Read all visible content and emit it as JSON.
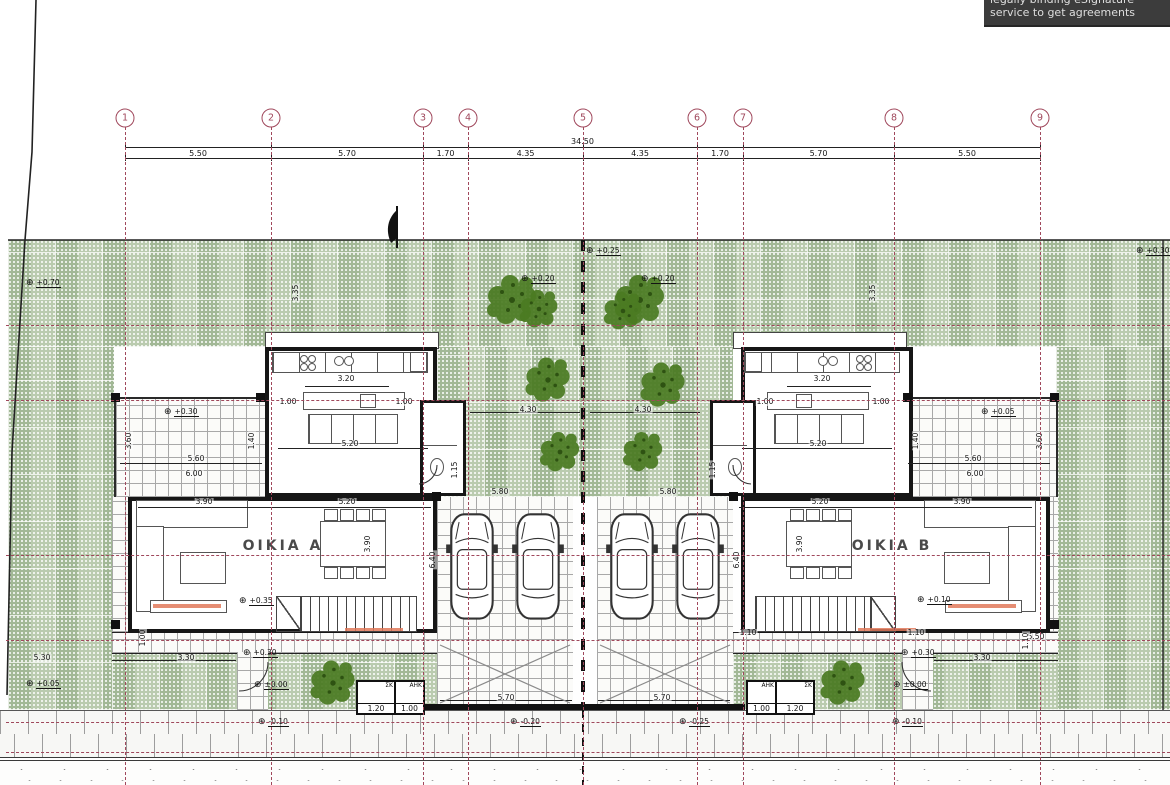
{
  "watermark": {
    "line1": "legally binding eSignature",
    "line2": "service to get agreements",
    "bg": "#3c3c3c",
    "fg": "#dedede"
  },
  "colors": {
    "axis_red": "#a0485c",
    "garden_green": "#b0c4a4",
    "tree_green": "#4b7b22",
    "wall_black": "#161616",
    "accent_orange": "#e0795a"
  },
  "grid": {
    "total_label": "34.50",
    "axes": [
      {
        "n": "1",
        "x": 125
      },
      {
        "n": "2",
        "x": 271
      },
      {
        "n": "3",
        "x": 423
      },
      {
        "n": "4",
        "x": 468
      },
      {
        "n": "5",
        "x": 583
      },
      {
        "n": "6",
        "x": 697
      },
      {
        "n": "7",
        "x": 743
      },
      {
        "n": "8",
        "x": 894
      },
      {
        "n": "9",
        "x": 1040
      }
    ],
    "segments": [
      "5.50",
      "5.70",
      "1.70",
      "4.35",
      "4.35",
      "1.70",
      "5.70",
      "5.50"
    ]
  },
  "houses": [
    {
      "name": "OIKIA A",
      "x": 283,
      "y": 546
    },
    {
      "name": "OIKIA B",
      "x": 892,
      "y": 546
    }
  ],
  "meter_boxes": [
    {
      "label": "ΣΚ",
      "value": "1.20",
      "x": 356,
      "y": 680,
      "w": 36,
      "h": 31
    },
    {
      "label": "ΑΗΚ",
      "value": "1.00",
      "x": 394,
      "y": 680,
      "w": 27,
      "h": 31
    },
    {
      "label": "ΑΗΚ",
      "value": "1.00",
      "x": 746,
      "y": 680,
      "w": 27,
      "h": 31
    },
    {
      "label": "ΣΚ",
      "value": "1.20",
      "x": 775,
      "y": 680,
      "w": 36,
      "h": 31
    }
  ],
  "levels": [
    {
      "label": "+0.70",
      "x": 30,
      "y": 283
    },
    {
      "label": "+0.25",
      "x": 590,
      "y": 251
    },
    {
      "label": "+0.20",
      "x": 525,
      "y": 279
    },
    {
      "label": "+0.20",
      "x": 645,
      "y": 279
    },
    {
      "label": "+0.30",
      "x": 1140,
      "y": 251
    },
    {
      "label": "+0.30",
      "x": 168,
      "y": 412
    },
    {
      "label": "+0.05",
      "x": 985,
      "y": 412
    },
    {
      "label": "+0.35",
      "x": 243,
      "y": 601
    },
    {
      "label": "+0.10",
      "x": 921,
      "y": 600
    },
    {
      "label": "+0.30",
      "x": 247,
      "y": 653
    },
    {
      "label": "±0.00",
      "x": 258,
      "y": 685
    },
    {
      "label": "-0.10",
      "x": 262,
      "y": 722
    },
    {
      "label": "-0.20",
      "x": 514,
      "y": 722
    },
    {
      "label": "-0.25",
      "x": 683,
      "y": 722
    },
    {
      "label": "+0.30",
      "x": 905,
      "y": 653
    },
    {
      "label": "±0.00",
      "x": 897,
      "y": 685
    },
    {
      "label": "-0.10",
      "x": 896,
      "y": 722
    },
    {
      "label": "+0.05",
      "x": 30,
      "y": 684
    }
  ],
  "dims": [
    {
      "label": "3.20",
      "x": 346,
      "y": 379
    },
    {
      "label": "1.00",
      "x": 288,
      "y": 402
    },
    {
      "label": "1.00",
      "x": 404,
      "y": 402
    },
    {
      "label": "5.20",
      "x": 350,
      "y": 444
    },
    {
      "label": "5.60",
      "x": 196,
      "y": 459
    },
    {
      "label": "6.00",
      "x": 194,
      "y": 474
    },
    {
      "label": "3.60",
      "x": 129,
      "y": 441,
      "rot": 1
    },
    {
      "label": "1.40",
      "x": 252,
      "y": 441,
      "rot": 1
    },
    {
      "label": "1.15",
      "x": 455,
      "y": 470,
      "rot": 1
    },
    {
      "label": "3.90",
      "x": 204,
      "y": 502
    },
    {
      "label": "5.20",
      "x": 347,
      "y": 502
    },
    {
      "label": "3.90",
      "x": 368,
      "y": 544,
      "rot": 1
    },
    {
      "label": "5.80",
      "x": 500,
      "y": 492
    },
    {
      "label": "6.40",
      "x": 433,
      "y": 560,
      "rot": 1
    },
    {
      "label": "4.30",
      "x": 528,
      "y": 410
    },
    {
      "label": "4.30",
      "x": 643,
      "y": 410
    },
    {
      "label": "3.35",
      "x": 296,
      "y": 293,
      "rot": 1
    },
    {
      "label": "3.35",
      "x": 873,
      "y": 293,
      "rot": 1
    },
    {
      "label": "3.30",
      "x": 186,
      "y": 658
    },
    {
      "label": "5.30",
      "x": 42,
      "y": 658
    },
    {
      "label": "1.00",
      "x": 143,
      "y": 638,
      "rot": 1
    },
    {
      "label": "5.70",
      "x": 506,
      "y": 698
    },
    {
      "label": "5.70",
      "x": 662,
      "y": 698
    },
    {
      "label": "3.20",
      "x": 822,
      "y": 379
    },
    {
      "label": "1.00",
      "x": 765,
      "y": 402
    },
    {
      "label": "1.00",
      "x": 881,
      "y": 402
    },
    {
      "label": "5.20",
      "x": 818,
      "y": 444
    },
    {
      "label": "5.60",
      "x": 973,
      "y": 459
    },
    {
      "label": "6.00",
      "x": 975,
      "y": 474
    },
    {
      "label": "3.60",
      "x": 1040,
      "y": 441,
      "rot": 1
    },
    {
      "label": "1.40",
      "x": 916,
      "y": 441,
      "rot": 1
    },
    {
      "label": "1.15",
      "x": 713,
      "y": 470,
      "rot": 1
    },
    {
      "label": "3.90",
      "x": 962,
      "y": 502
    },
    {
      "label": "5.20",
      "x": 820,
      "y": 502
    },
    {
      "label": "3.90",
      "x": 800,
      "y": 544,
      "rot": 1
    },
    {
      "label": "5.80",
      "x": 668,
      "y": 492
    },
    {
      "label": "6.40",
      "x": 737,
      "y": 560,
      "rot": 1
    },
    {
      "label": "3.30",
      "x": 982,
      "y": 658
    },
    {
      "label": "5.50",
      "x": 1036,
      "y": 637
    },
    {
      "label": "1.10",
      "x": 748,
      "y": 633
    },
    {
      "label": "1.10",
      "x": 916,
      "y": 633
    },
    {
      "label": "1.10",
      "x": 1026,
      "y": 641,
      "rot": 1
    }
  ]
}
